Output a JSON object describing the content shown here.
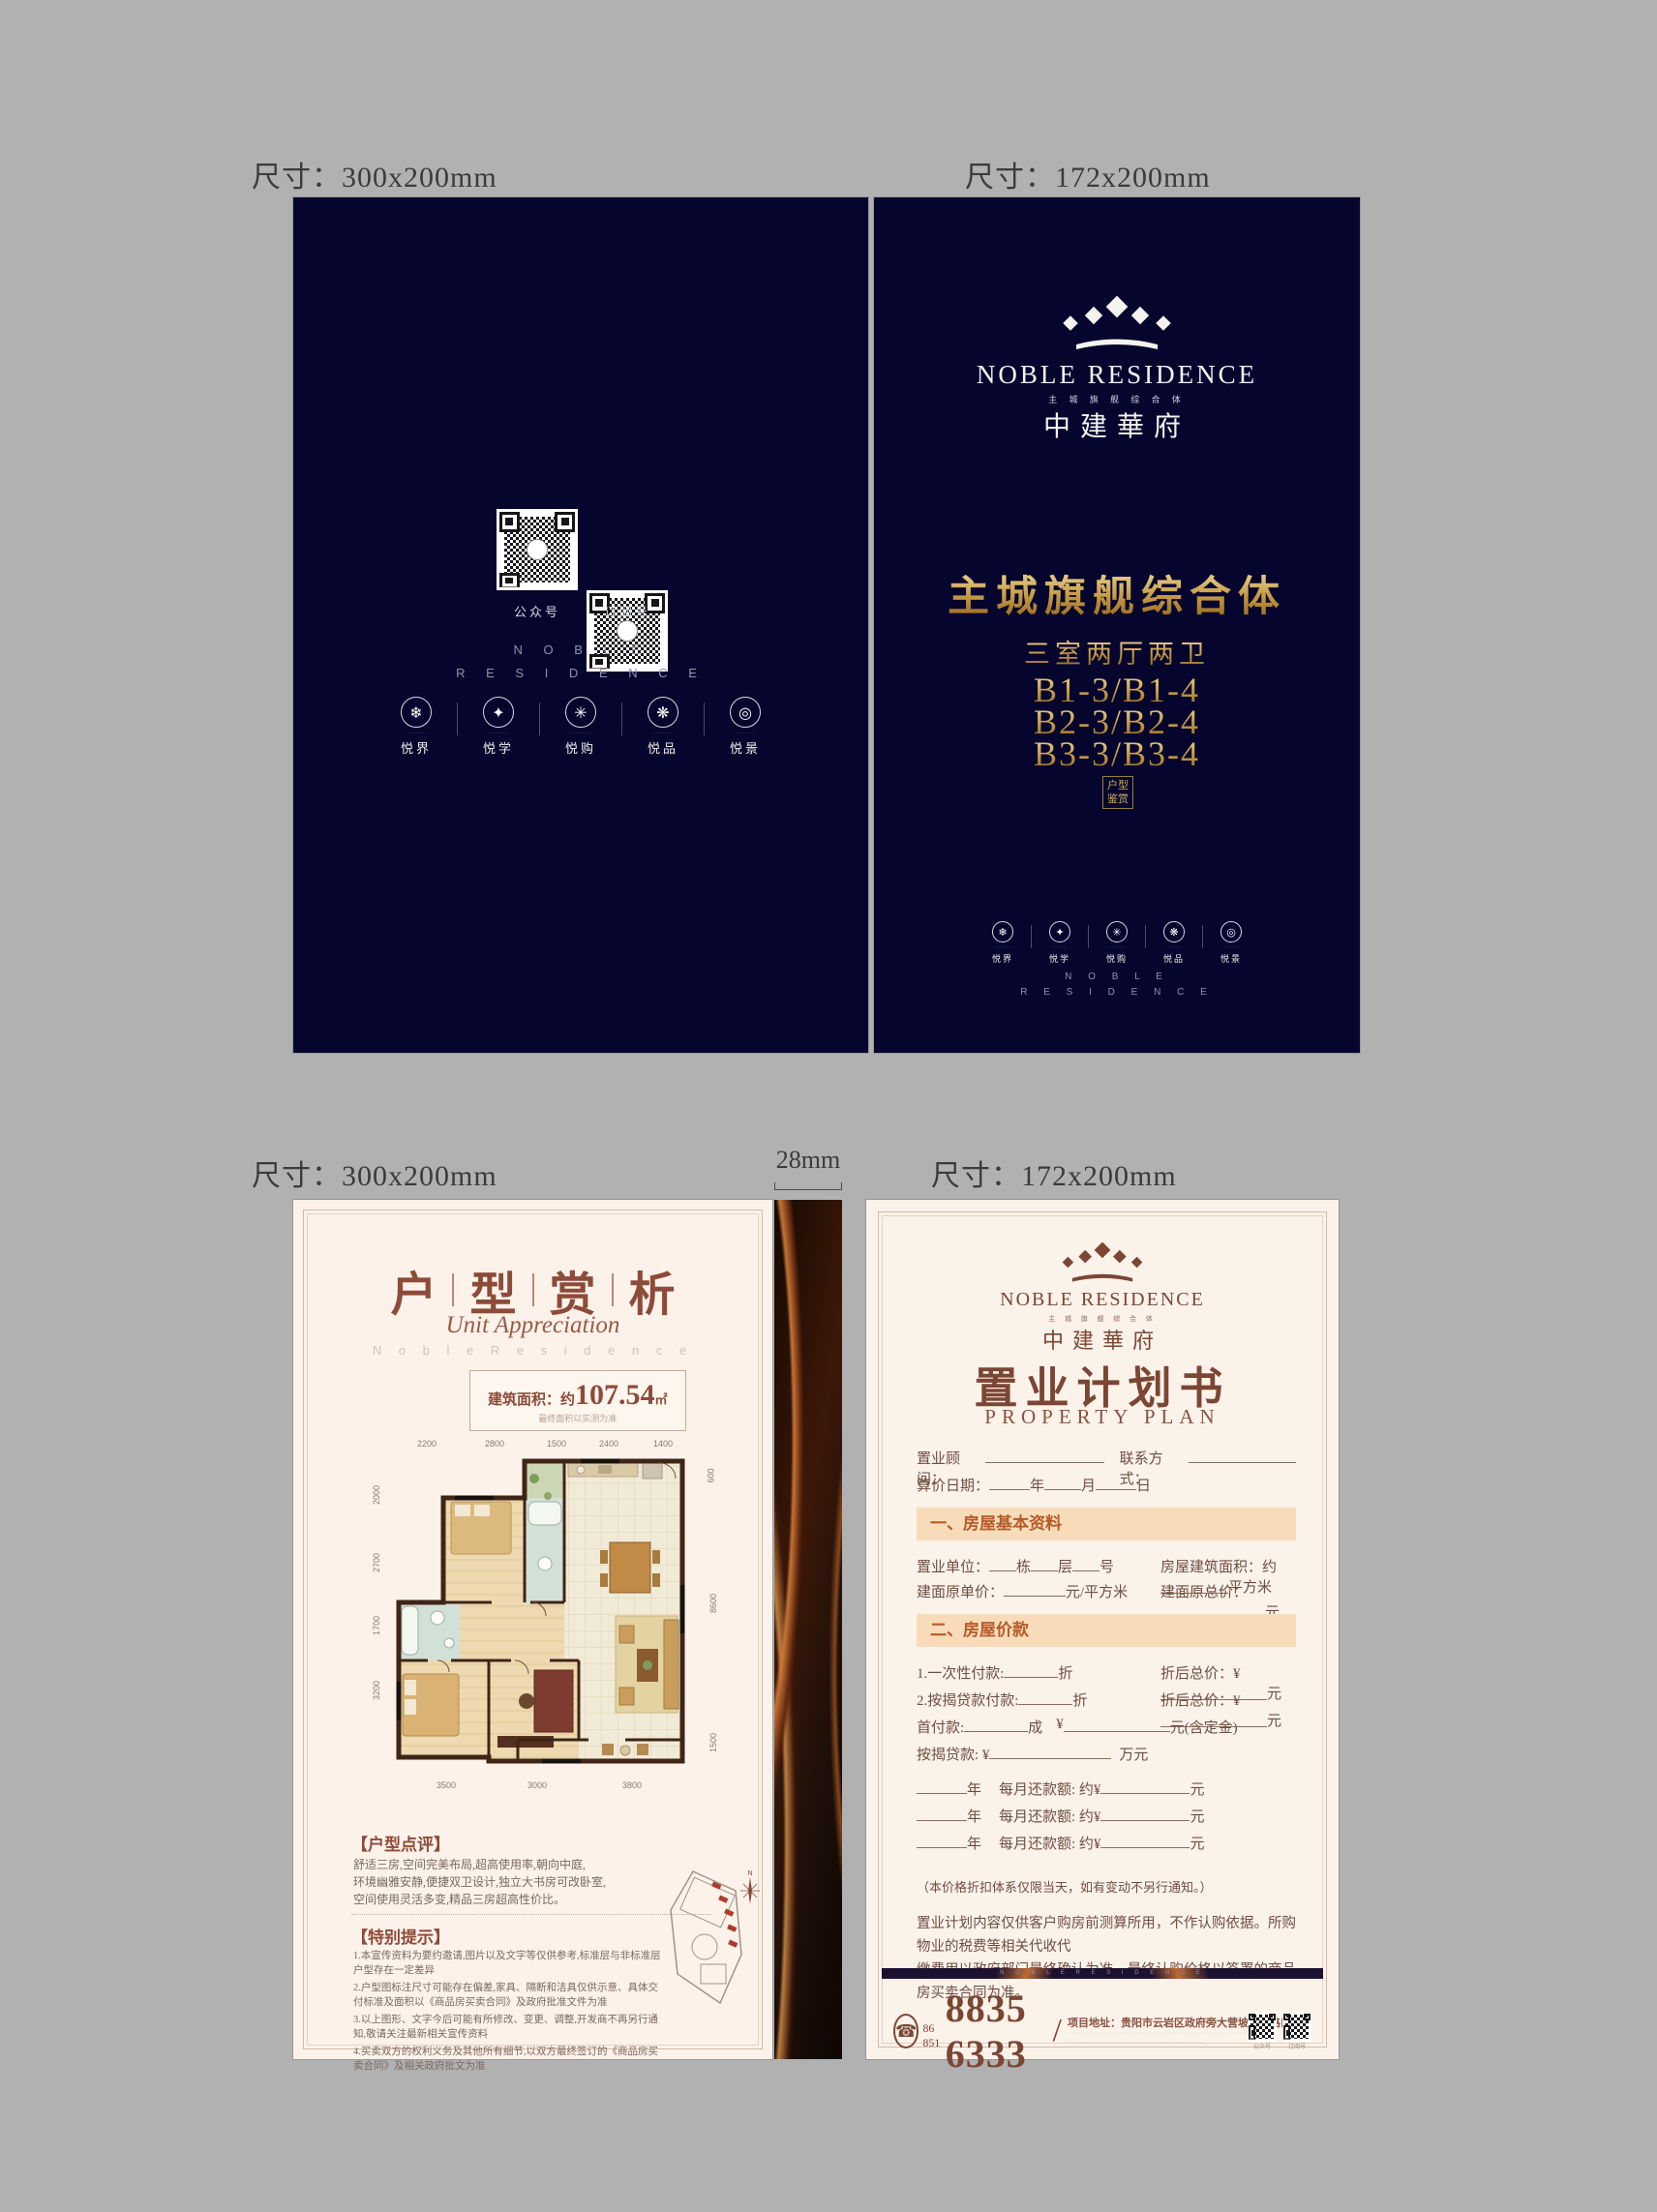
{
  "labels": {
    "size_300": "尺寸：300x200mm",
    "size_172": "尺寸：172x200mm",
    "spine": "28mm"
  },
  "brand": {
    "en": "NOBLE RESIDENCE",
    "en_spaced_1": "N O B L E",
    "en_spaced_2": "R E S I D E N C E",
    "tagline_spaced": "主 城 旗 舰 综 合 体",
    "cn": "中建華府"
  },
  "amenities": {
    "items": [
      {
        "icon": "❄",
        "caption": "·············",
        "label": "悦界"
      },
      {
        "icon": "✦",
        "caption": "·············",
        "label": "悦学"
      },
      {
        "icon": "✳",
        "caption": "·············",
        "label": "悦购"
      },
      {
        "icon": "❋",
        "caption": "·············",
        "label": "悦品"
      },
      {
        "icon": "◎",
        "caption": "·············",
        "label": "悦景"
      }
    ]
  },
  "back_cover": {
    "qr1_label": "公众号",
    "qr2_label": "订阅号"
  },
  "front_cover": {
    "headline": "主城旗舰综合体",
    "subhead": "三室两厅两卫",
    "unit_line_1": "B1-3/B1-4",
    "unit_line_2": "B2-3/B2-4",
    "unit_line_3": "B3-3/B3-4",
    "stamp_row_1": "户型",
    "stamp_row_2": "鉴赏"
  },
  "floor_page": {
    "title_char_1": "户",
    "title_char_2": "型",
    "title_char_3": "赏",
    "title_char_4": "析",
    "subtitle_script": "Unit Appreciation",
    "subtitle_spaced": "N o b l e   R e s i d e n c e",
    "area_prefix": "建筑面积：约",
    "area_value": "107.54",
    "area_unit": "㎡",
    "area_note": "最终面积以实测为准",
    "dims_top": [
      "2200",
      "2800",
      "1500",
      "2400",
      "1400"
    ],
    "dims_left": [
      "2000",
      "2700",
      "1700",
      "3200"
    ],
    "dims_right": [
      "600",
      "8600",
      "1500"
    ],
    "dims_bottom": [
      "3500",
      "3000",
      "3800"
    ],
    "compass_n": "N",
    "review_title": "【户型点评】",
    "review_lines": [
      "舒适三房,空间完美布局,超高使用率,朝向中庭,",
      "环境幽雅安静,便捷双卫设计,独立大书房可改卧室,",
      "空间使用灵活多变,精品三房超高性价比。"
    ],
    "notice_title": "【特别提示】",
    "notice_items": [
      "1.本宣传资料为要约邀请,图片以及文字等仅供参考,标准层与非标准层户型存在一定差异",
      "2.户型图标注尺寸可能存在偏差,家具、隔断和洁具仅供示意、具体交付标准及面积以《商品房买卖合同》及政府批准文件为准",
      "3.以上图形、文字今后可能有所修改、变更、调整,开发商不再另行通知,敬请关注最新相关宣传资料",
      "4.买卖双方的权利义务及其他所有细节,以双方最终签订的《商品房买卖合同》及相关政府批文为准"
    ]
  },
  "plan_page": {
    "title": "置业计划书",
    "subtitle": "PROPERTY  PLAN",
    "consultant_label": "置业顾问：",
    "contact_label": "联系方式：",
    "date_label": "算价日期：",
    "unit_year": "年",
    "unit_month": "月",
    "unit_day": "日",
    "section1_title": "一、房屋基本资料",
    "unit_label": "置业单位：",
    "unit_dong": "栋",
    "unit_ceng": "层",
    "unit_hao": "号",
    "barea_label": "房屋建筑面积：约",
    "barea_unit": "平方米",
    "uprice_label": "建面原单价：",
    "uprice_unit": "元/平方米",
    "tprice_label": "建面原总价：",
    "tprice_unit": "元",
    "section2_title": "二、房屋价款",
    "pay1_label": "1.一次性付款:",
    "fold_unit": "折",
    "discount_label": "折后总价：¥",
    "yuan": "元",
    "pay2_label": "2.按揭贷款付款:",
    "down_label": "首付款:",
    "cheng_unit": "成",
    "yen": "¥",
    "deposit_suffix": "元(含定金)",
    "loan_label": "按揭贷款: ¥",
    "wan_unit": "万元",
    "monthly_year_unit": "年",
    "monthly_label": "每月还款额: 约¥",
    "note": "（本价格折扣体系仅限当天，如有变动不另行通知。）",
    "para_line_1": "置业计划内容仅供客户购房前测算所用，不作认购依据。所购物业的税费等相关代收代",
    "para_line_2": "缴费用以政府部门最终确认为准，最终认购价格以签署的商品房买卖合同为准。",
    "band_brand": "N O B L E   R E S I D E N C E",
    "footer": {
      "phone_prefix": "86 851",
      "phone": "8835 6333",
      "slash": "/",
      "address": "项目地址：贵阳市云岩区政府旁大营坡常青路口",
      "fine_line_1": "····································································",
      "fine_line_2": "··················································",
      "qr1_label": "公众号",
      "qr2_label": "订阅号"
    }
  }
}
